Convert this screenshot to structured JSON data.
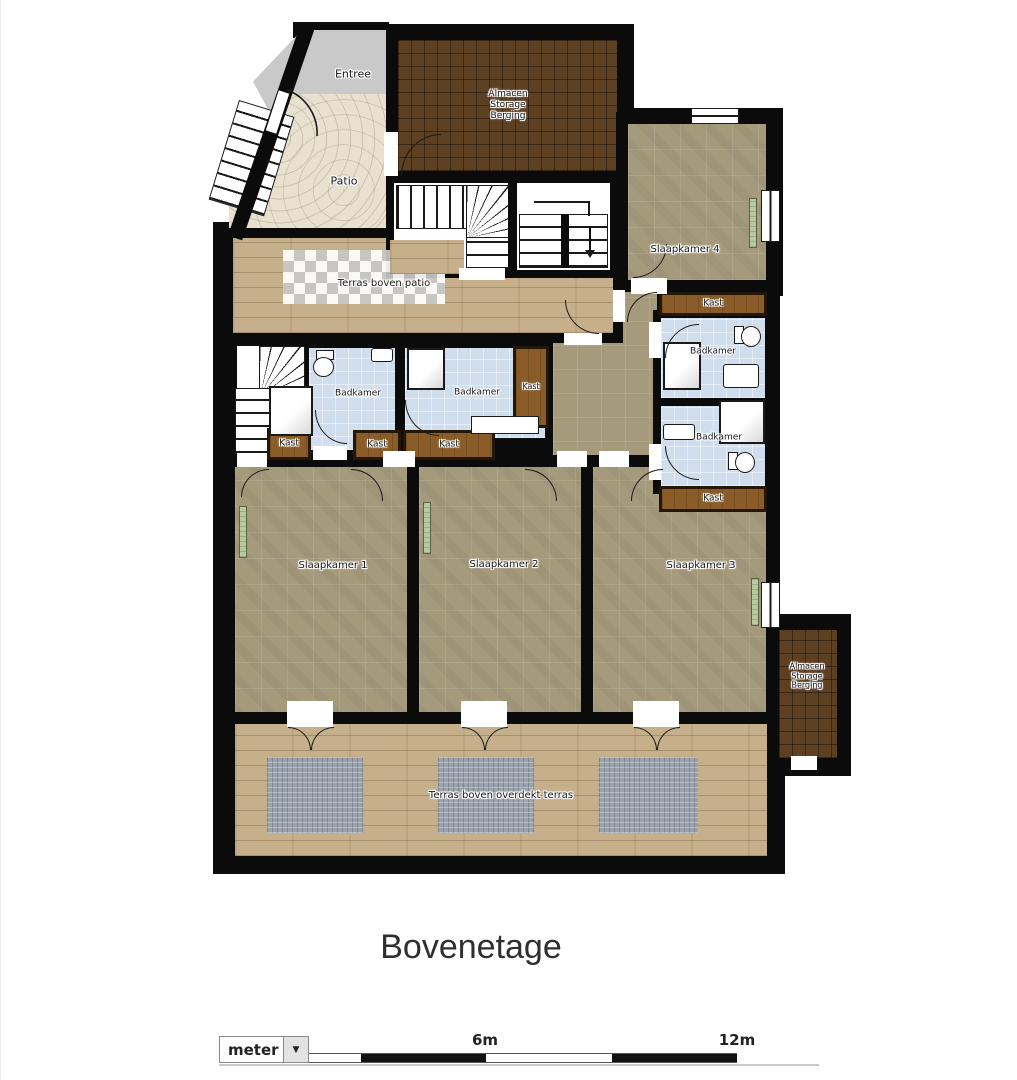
{
  "floorplan": {
    "title": "Bovenetage",
    "rooms": {
      "entree": "Entree",
      "patio": "Patio",
      "storage": {
        "line1": "Almacen",
        "line2": "Storage",
        "line3": "Berging"
      },
      "terras_patio": "Terras boven patio",
      "slaapkamer1": "Slaapkamer 1",
      "slaapkamer2": "Slaapkamer 2",
      "slaapkamer3": "Slaapkamer 3",
      "slaapkamer4": "Slaapkamer 4",
      "badkamer": "Badkamer",
      "kast": "Kast",
      "terras_overdekt": "Terras boven overdekt terras"
    },
    "colors": {
      "wall": "#0b0b0b",
      "bedroom_floor": "#a69a7d",
      "bathroom_floor": "#cfdded",
      "closet_brown": "#8a5c28",
      "storage_tile": "#5d3f22",
      "terrace_wood": "#c6b08c",
      "patio_stone": "#e8e1d0",
      "entry_gray": "#c9c9c9",
      "radiator_green": "#b9c9a0",
      "mat_gray": "#9aa2ae",
      "checker_gray": "#c8c8c8"
    },
    "scalebar": {
      "unit": "meter",
      "mid_label": "6m",
      "end_label": "12m",
      "arrow_icon": "▼"
    }
  }
}
